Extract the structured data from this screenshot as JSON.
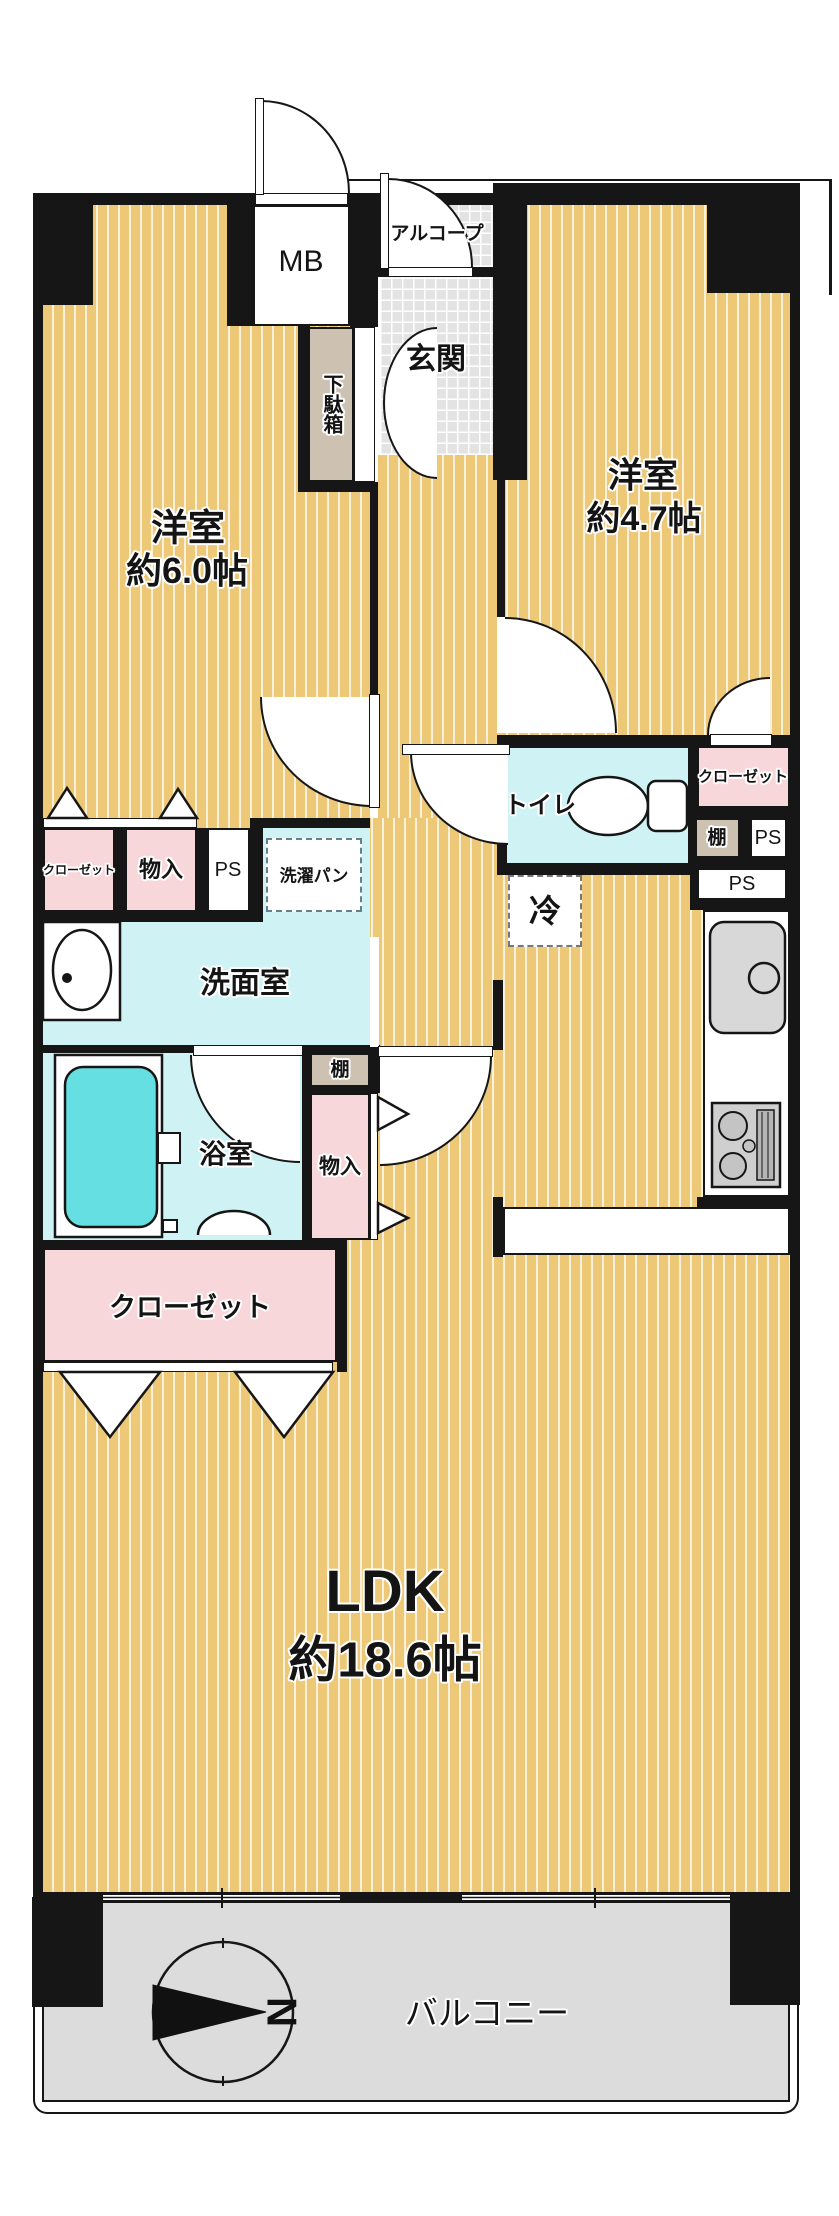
{
  "title": "apartment-floorplan",
  "labels": {
    "mb": "MB",
    "alcove": "アルコープ",
    "genkan": "玄関",
    "shoe_cabinet": "下駄箱",
    "bedroom1_name": "洋室",
    "bedroom1_size": "約6.0帖",
    "bedroom2_name": "洋室",
    "bedroom2_size": "約4.7帖",
    "toilet": "トイレ",
    "closet_right": "クローゼット",
    "shelf_right": "棚",
    "ps_right_upper": "PS",
    "ps_right_lower": "PS",
    "closet_left": "クローゼット",
    "storage_left": "物入",
    "ps_left": "PS",
    "laundry_pan": "洗濯パン",
    "washroom": "洗面室",
    "fridge": "冷",
    "shelf_bath": "棚",
    "storage_bath": "物入",
    "bathroom": "浴室",
    "closet_bottom": "クローゼット",
    "ldk_name": "LDK",
    "ldk_size": "約18.6帖",
    "balcony": "バルコニー",
    "compass_north": "N"
  },
  "colors": {
    "wall": "#161616",
    "flooring": "#ecc877",
    "closet_pink": "#f8d7da",
    "wet_area_cyan": "#cff2f4",
    "bathtub": "#66dfe2",
    "entrance_tile": "#e3e3e3",
    "balcony_gray": "#dcdcdc",
    "fixture_gray": "#d8d8d8"
  }
}
